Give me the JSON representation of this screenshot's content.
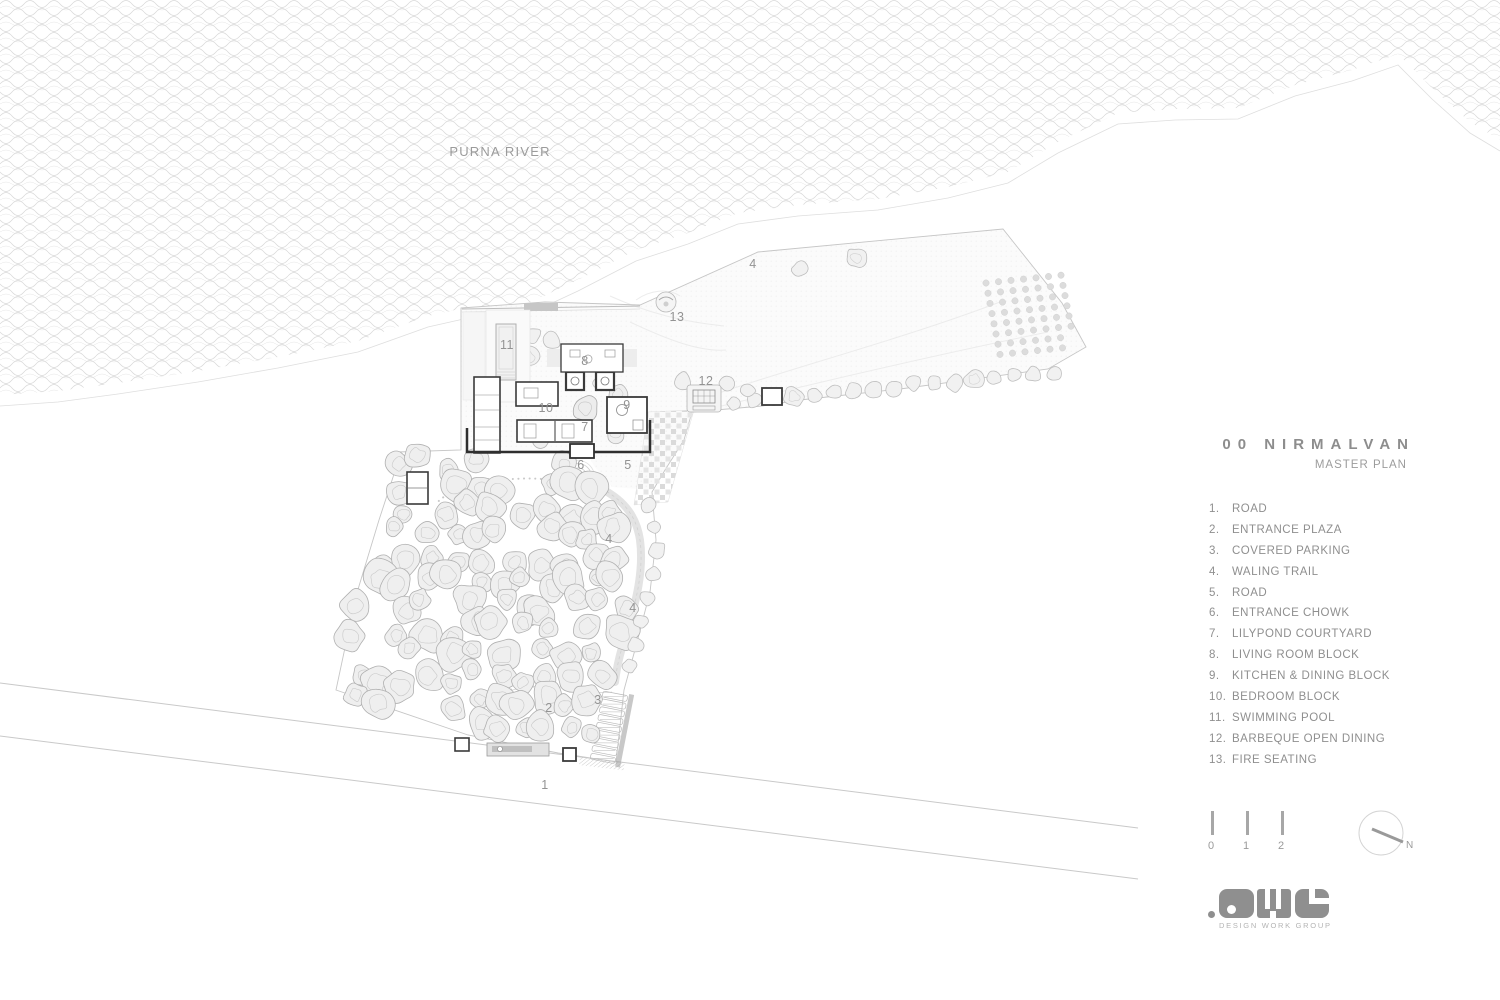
{
  "river": {
    "label": "PURNA RIVER"
  },
  "plan": {
    "labels": [
      {
        "n": "1",
        "x": 545,
        "y": 789
      },
      {
        "n": "2",
        "x": 549,
        "y": 712
      },
      {
        "n": "3",
        "x": 598,
        "y": 704
      },
      {
        "n": "4",
        "x": 753,
        "y": 268
      },
      {
        "n": "4",
        "x": 609,
        "y": 543
      },
      {
        "n": "4",
        "x": 633,
        "y": 612
      },
      {
        "n": "5",
        "x": 628,
        "y": 469
      },
      {
        "n": "6",
        "x": 581,
        "y": 469
      },
      {
        "n": "7",
        "x": 585,
        "y": 431
      },
      {
        "n": "8",
        "x": 585,
        "y": 365
      },
      {
        "n": "9",
        "x": 627,
        "y": 409
      },
      {
        "n": "10",
        "x": 546,
        "y": 412
      },
      {
        "n": "11",
        "x": 507,
        "y": 349
      },
      {
        "n": "12",
        "x": 706,
        "y": 385
      },
      {
        "n": "13",
        "x": 677,
        "y": 321
      }
    ]
  },
  "panel": {
    "title": "00 NIRMALVAN",
    "subtitle": "MASTER PLAN",
    "legend": [
      {
        "num": "1.",
        "label": "ROAD"
      },
      {
        "num": "2.",
        "label": "ENTRANCE PLAZA"
      },
      {
        "num": "3.",
        "label": "COVERED PARKING"
      },
      {
        "num": "4.",
        "label": "WALING TRAIL"
      },
      {
        "num": "5.",
        "label": "ROAD"
      },
      {
        "num": "6.",
        "label": "ENTRANCE CHOWK"
      },
      {
        "num": "7.",
        "label": "LILYPOND COURTYARD"
      },
      {
        "num": "8.",
        "label": "LIVING ROOM BLOCK"
      },
      {
        "num": "9.",
        "label": "KITCHEN & DINING BLOCK"
      },
      {
        "num": "10.",
        "label": "BEDROOM BLOCK"
      },
      {
        "num": "11.",
        "label": "SWIMMING POOL"
      },
      {
        "num": "12.",
        "label": "BARBEQUE OPEN DINING"
      },
      {
        "num": "13.",
        "label": "FIRE SEATING"
      }
    ]
  },
  "scalebar": {
    "ticks": [
      "0",
      "1",
      "2"
    ]
  },
  "north": {
    "label": "N"
  },
  "logo": {
    "letters": "DWG",
    "caption": "DESIGN WORK GROUP"
  },
  "colors": {
    "label_gray": "#939393",
    "text_gray": "#8f8f8f",
    "line_gray": "#c9c9c9",
    "wave_gray": "#d8d8d8",
    "wall_dark": "#3a3a3a"
  }
}
